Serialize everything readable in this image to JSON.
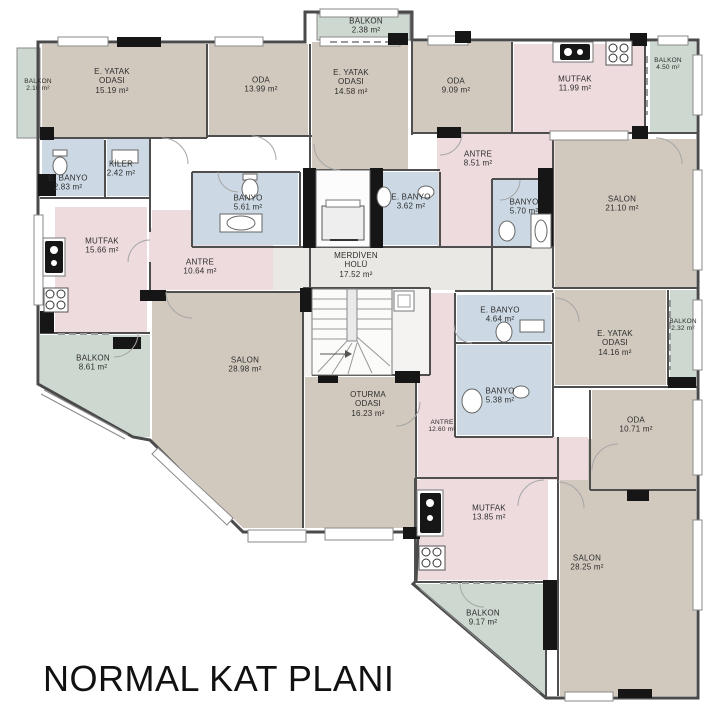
{
  "title": "NORMAL KAT PLANI",
  "plan": {
    "unit": "m²",
    "rooms": [
      {
        "id": "balkon-top-left",
        "name": "BALKON",
        "area": "2.10 m²"
      },
      {
        "id": "e-yatak-odasi-1",
        "name": "E. YATAK ODASI",
        "area": "15.19 m²"
      },
      {
        "id": "oda-1",
        "name": "ODA",
        "area": "13.99 m²"
      },
      {
        "id": "balkon-top-center",
        "name": "BALKON",
        "area": "2.38 m²"
      },
      {
        "id": "e-yatak-odasi-2",
        "name": "E. YATAK ODASI",
        "area": "14.58 m²"
      },
      {
        "id": "oda-2",
        "name": "ODA",
        "area": "9.09 m²"
      },
      {
        "id": "mutfak-1",
        "name": "MUTFAK",
        "area": "11.99 m²"
      },
      {
        "id": "balkon-top-right",
        "name": "BALKON",
        "area": "4.50 m²"
      },
      {
        "id": "e-banyo-1",
        "name": "E. BANYO",
        "area": "2.83 m²"
      },
      {
        "id": "kiler",
        "name": "KİLER",
        "area": "2.42 m²"
      },
      {
        "id": "banyo-1",
        "name": "BANYO",
        "area": "5.61 m²"
      },
      {
        "id": "e-banyo-2",
        "name": "E. BANYO",
        "area": "3.62 m²"
      },
      {
        "id": "antre-1",
        "name": "ANTRE",
        "area": "8.51 m²"
      },
      {
        "id": "banyo-2",
        "name": "BANYO",
        "area": "5.70 m²"
      },
      {
        "id": "salon-1",
        "name": "SALON",
        "area": "21.10 m²"
      },
      {
        "id": "mutfak-2",
        "name": "MUTFAK",
        "area": "15.66 m²"
      },
      {
        "id": "antre-2",
        "name": "ANTRE",
        "area": "10.64 m²"
      },
      {
        "id": "merdiven-holu",
        "name": "MERDİVEN HOLÜ",
        "area": "17.52 m²"
      },
      {
        "id": "e-banyo-3",
        "name": "E. BANYO",
        "area": "4.64 m²"
      },
      {
        "id": "e-yatak-odasi-3",
        "name": "E. YATAK ODASI",
        "area": "14.16 m²"
      },
      {
        "id": "balkon-right",
        "name": "BALKON",
        "area": "2.32 m²"
      },
      {
        "id": "balkon-left",
        "name": "BALKON",
        "area": "8.61 m²"
      },
      {
        "id": "salon-2",
        "name": "SALON",
        "area": "28.98 m²"
      },
      {
        "id": "oturma-odasi",
        "name": "OTURMA ODASI",
        "area": "16.23 m²"
      },
      {
        "id": "banyo-3",
        "name": "BANYO",
        "area": "5.38 m²"
      },
      {
        "id": "antre-3",
        "name": "ANTRE",
        "area": "12.60 m²"
      },
      {
        "id": "oda-3",
        "name": "ODA",
        "area": "10.71 m²"
      },
      {
        "id": "mutfak-3",
        "name": "MUTFAK",
        "area": "13.85 m²"
      },
      {
        "id": "salon-3",
        "name": "SALON",
        "area": "28.25 m²"
      },
      {
        "id": "balkon-bottom",
        "name": "BALKON",
        "area": "9.17 m²"
      }
    ]
  },
  "colors": {
    "room_beige": "#d1c9be",
    "kitchen_hall_pink": "#eedbde",
    "bath_blue": "#ccd9e4",
    "balcony_green": "#cdd8d0",
    "hall_gray": "#eae8e4",
    "wall_dark": "#4a4a4a",
    "pier_black": "#161616"
  }
}
